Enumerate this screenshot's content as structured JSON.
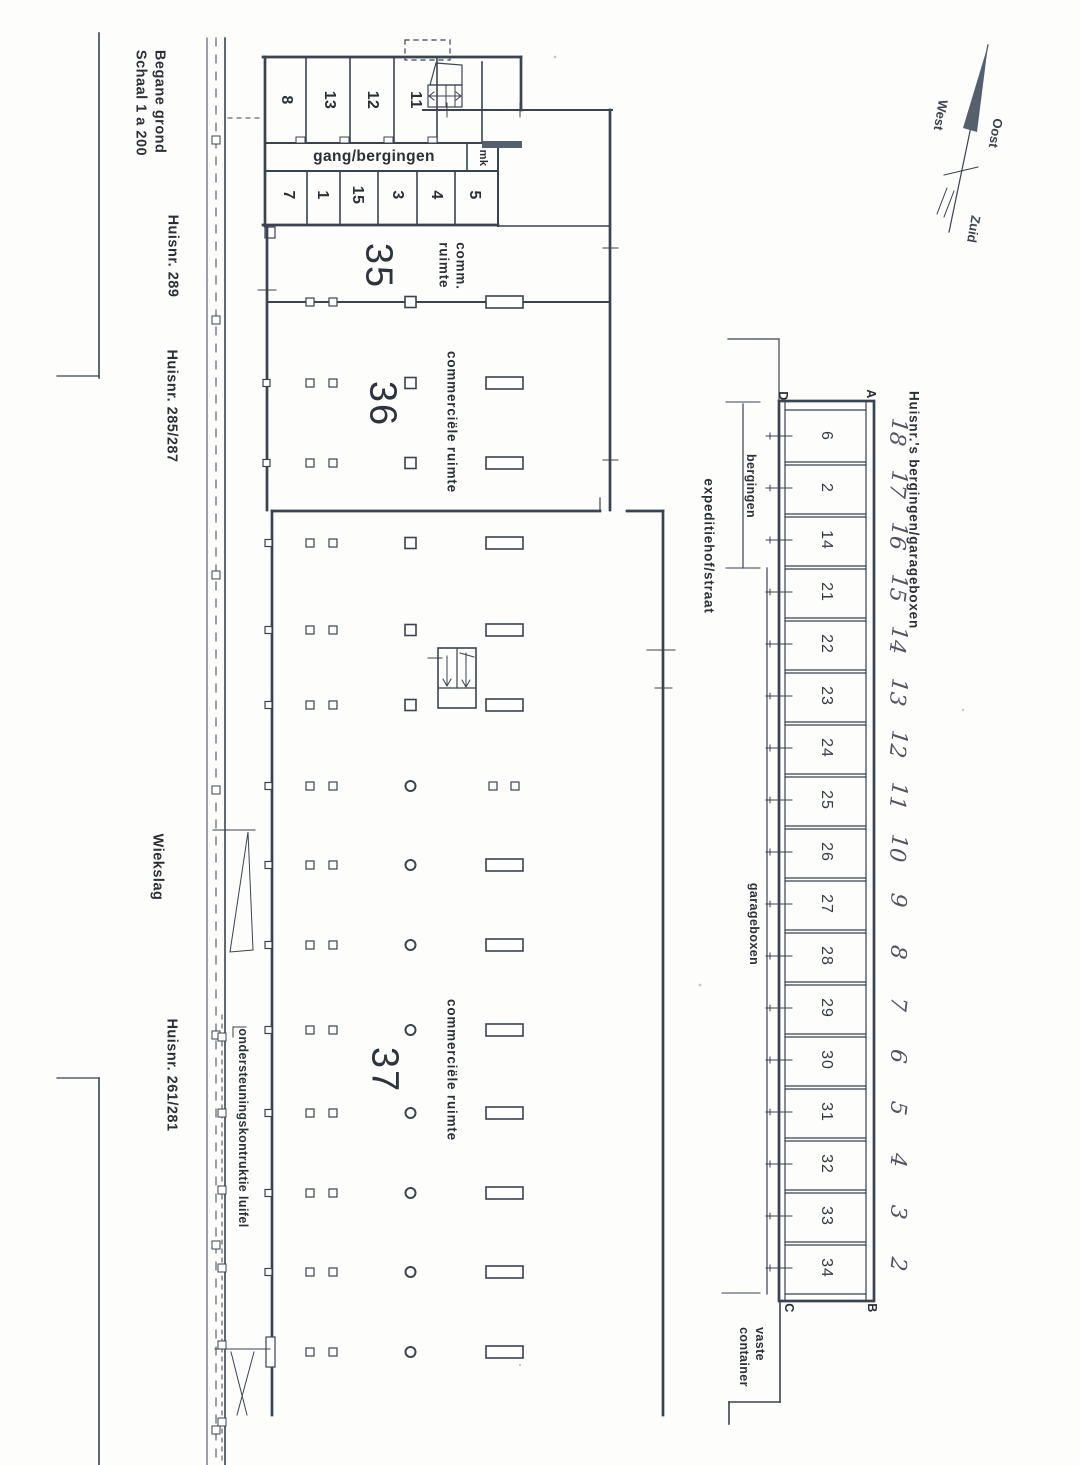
{
  "document": {
    "title_block": "Begane grond\nSchaal 1 a 200"
  },
  "street": {
    "labels": [
      {
        "id": "huisnr-289",
        "text": "Huisnr. 289"
      },
      {
        "id": "huisnr-285-287",
        "text": "Huisnr. 285/287"
      },
      {
        "id": "wiekslag",
        "text": "Wiekslag"
      },
      {
        "id": "huisnr-261-281",
        "text": "Huisnr. 261/281"
      }
    ],
    "canopy_note": "ondersteuningskontruktie luifel"
  },
  "storage_cluster": {
    "corridor_label": "gang/bergingen",
    "mk_label": "mk",
    "top_row": [
      "8",
      "13",
      "12",
      "11"
    ],
    "bottom_row": [
      "7",
      "1",
      "15",
      "3",
      "4",
      "5"
    ]
  },
  "units": {
    "unit35": {
      "number": "35",
      "label": "comm.\nruimte"
    },
    "unit36": {
      "number": "36",
      "label": "commerciële ruimte"
    },
    "unit37": {
      "number": "37",
      "label": "commerciële ruimte"
    }
  },
  "yard": {
    "expeditiehof": "expeditiehof/straat",
    "bergingen_dim": "bergingen",
    "garageboxen_dim": "garageboxen",
    "container": "vaste\ncontainer"
  },
  "garage": {
    "title": "Huisnr.'s bergingen/garageboxen",
    "corners": {
      "top_left": "D",
      "top_right": "A",
      "bottom_left": "C",
      "bottom_right": "B"
    },
    "boxes": [
      "6",
      "2",
      "14",
      "21",
      "22",
      "23",
      "24",
      "25",
      "26",
      "27",
      "28",
      "29",
      "30",
      "31",
      "32",
      "33",
      "34"
    ],
    "handwritten": [
      "18",
      "17",
      "16",
      "15",
      "14",
      "13",
      "12",
      "11",
      "10",
      "9",
      "8",
      "7",
      "6",
      "5",
      "4",
      "3",
      "2"
    ]
  },
  "compass": {
    "west": "West",
    "oost": "Oost",
    "zuid": "Zuid"
  },
  "colors": {
    "line": "#3a4350",
    "text": "#2b2f36",
    "handwriting": "#575061",
    "needle": "#55606e",
    "paper": "#fdfdfc"
  }
}
